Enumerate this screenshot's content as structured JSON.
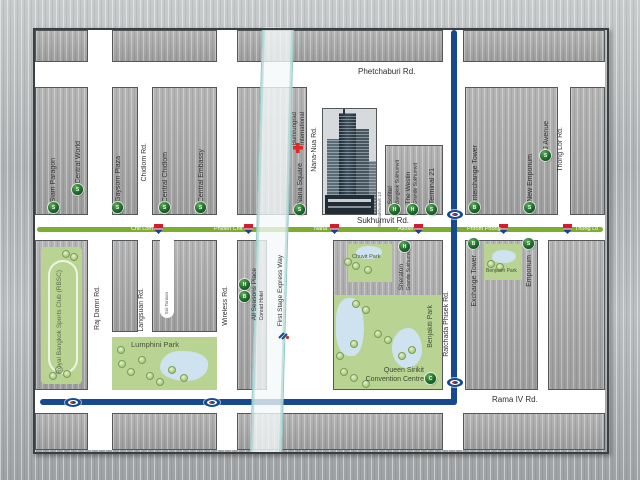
{
  "roads": {
    "phetchaburi": "Phetchaburi Rd.",
    "sukhumvit": "Sukhumvit Rd.",
    "rama4": "Rama IV Rd.",
    "rajdamri": "Raj Damri Rd.",
    "chidlom": "Chidlom Rd.",
    "langsuan": "Langsuan Rd.",
    "soi_tonson": "Soi Tonson",
    "wireless": "Wireless Rd.",
    "nana_nua": "Nana-Nua Rd.",
    "soi_sukhumvit13": "Soi Sukhumvit 13",
    "thong_lor": "Thong Lor Rd.",
    "ratchada": "Ratchada Phisek Rd.",
    "expressway": "First Stage Express Way"
  },
  "stations": {
    "chit_lom": "Chit Lom",
    "phloen_chit": "Phloen Chit",
    "nana": "Nana",
    "asoke": "Asoke",
    "phrom_phong": "Phrom Phong",
    "thong_lo": "Thong Lo"
  },
  "places": {
    "siam_paragon": {
      "label": "Siam Paragon",
      "marker": "S"
    },
    "central_world": {
      "label": "Central World",
      "marker": "S"
    },
    "gaysorn_plaza": {
      "label": "Gaysorn Plaza",
      "marker": "S"
    },
    "central_chidlom": {
      "label": "Central Chidlom",
      "marker": "S"
    },
    "central_embassy": {
      "label": "Central Embassy",
      "marker": "S"
    },
    "nana_square": {
      "label": "Nana Square",
      "marker": "S"
    },
    "bumrungrad": {
      "line1": "Bumrungrad",
      "line2": "International"
    },
    "sofitel": {
      "line1": "Sofitel",
      "line2": "Bangkok Sukhumvit",
      "marker": "H"
    },
    "westin": {
      "line1": "The Westin",
      "line2": "Grande Sukhumvit",
      "marker": "H"
    },
    "terminal21": {
      "label": "Terminal 21",
      "marker": "S"
    },
    "interchange_tower": {
      "label": "Interchange Tower",
      "marker": "B"
    },
    "new_emporium": {
      "label": "New Emporium",
      "marker": "S"
    },
    "j_avenue": {
      "label": "J Avenue",
      "marker": "S"
    },
    "all_seasons": {
      "line1": "All Seasons Place",
      "line2": "Conrad Hotel",
      "marker_hotel": "H",
      "marker_building": "B"
    },
    "sheraton": {
      "line1": "Sheraton",
      "line2": "Grande Sukhumvit",
      "marker": "H"
    },
    "exchange_tower": {
      "label": "Exchange Tower",
      "marker": "B"
    },
    "emporium": {
      "label": "Emporium",
      "marker": "S"
    },
    "queen_sirikit": {
      "line1": "Queen Sirikit",
      "line2": "Convention Centre",
      "marker": "C"
    }
  },
  "parks": {
    "rbsc": "Royal Bangkok Sports Club (RBSC)",
    "lumphini": "Lumphini Park",
    "chuvit": "Chuvit Park",
    "benjakiti": "Benjakiti Park",
    "benjasiri": "Benjasiri Park"
  },
  "colors": {
    "sukhumvit_line": "#7dad2e",
    "blue_road": "#17498f",
    "park_green": "#b9d492",
    "pond_blue": "#cfe2ef",
    "marker_green": "#1c6b2c",
    "bts_red": "#cf1f2e",
    "bts_blue": "#16458c",
    "expressway_edge": "#8fc8c3"
  }
}
